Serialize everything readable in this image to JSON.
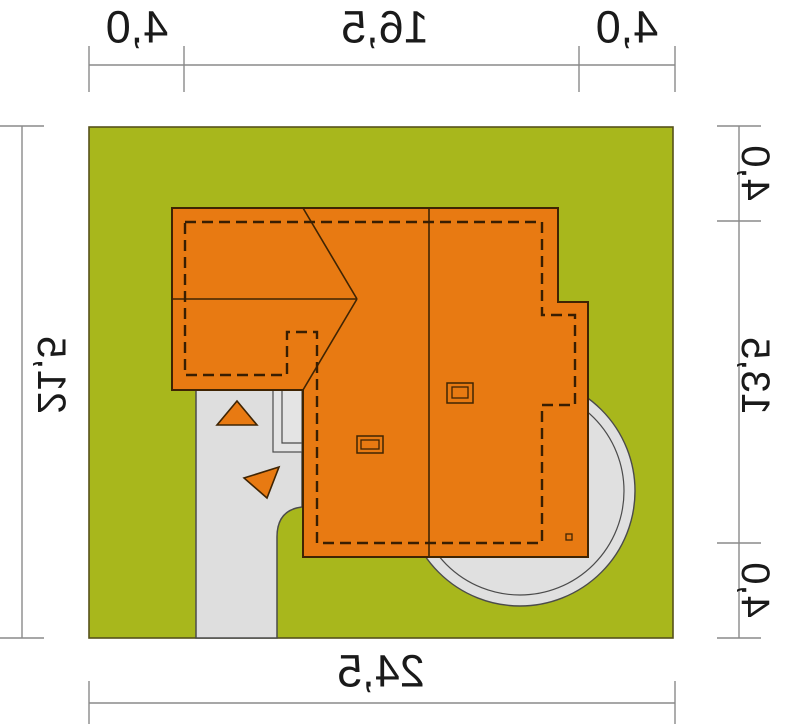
{
  "plan": {
    "kind": "house-site-plan-mirrored-preview",
    "dims": {
      "width_segments": [
        "4,0",
        "16,5",
        "4,0"
      ],
      "width_total": "24,5",
      "height_segments": [
        "4,0",
        "13,5",
        "4,0"
      ],
      "height_total": "21,5"
    },
    "colors": {
      "grass": "#a8b71c",
      "grass_border": "#56511b",
      "roof": "#e87a12",
      "roof_line": "#3f2403",
      "building_outline_dash": "#381e02",
      "paving": "#dedede",
      "paving_line": "#4b4b4b",
      "dimension_line": "#8a8a8a",
      "dimension_text": "#1a1a1a",
      "background": "#ffffff"
    }
  }
}
